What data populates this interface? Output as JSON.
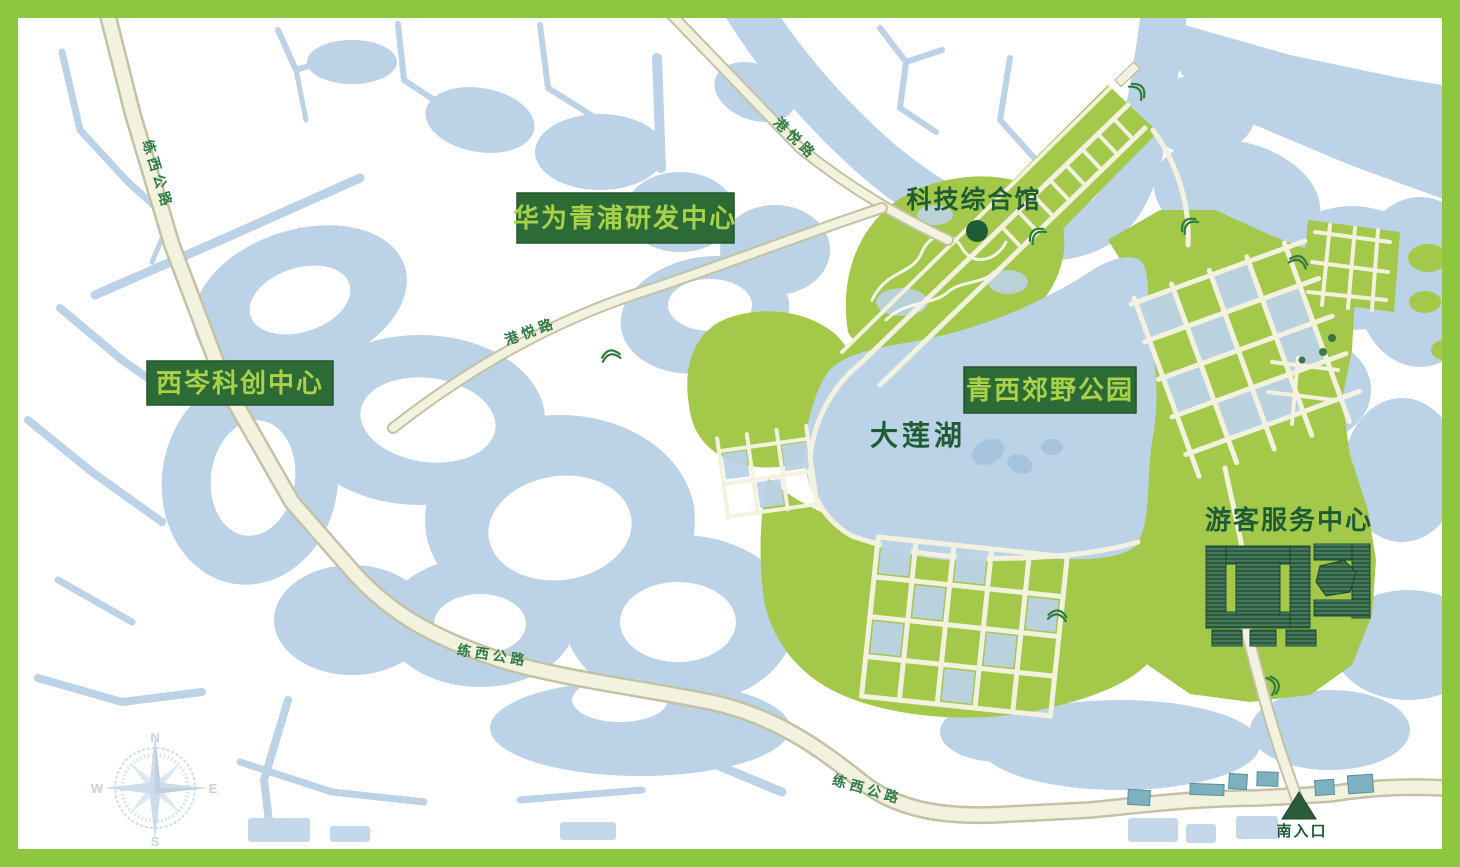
{
  "badges": [
    {
      "id": "huawei-rd-center",
      "label": "华为青浦研发中心"
    },
    {
      "id": "xicen-innovation-center",
      "label": "西岑科创中心"
    },
    {
      "id": "qingxi-country-park",
      "label": "青西郊野公园"
    }
  ],
  "poi": {
    "tech_hall": {
      "label": "科技综合馆",
      "marker": "circle-marker"
    },
    "dalian_lake": {
      "label": "大莲湖"
    },
    "visitor_center": {
      "label": "游客服务中心"
    },
    "south_entrance": {
      "label": "南入口",
      "marker": "triangle-marker"
    }
  },
  "road_labels": [
    {
      "road": "gangyue-road",
      "text": "港悦路"
    },
    {
      "road": "gangyue-road",
      "text": "港悦路"
    },
    {
      "road": "lianxi-highway",
      "text": "练西公路"
    },
    {
      "road": "lianxi-highway",
      "text": "练西公路"
    },
    {
      "road": "lianxi-highway",
      "text": "练西公路"
    }
  ],
  "compass": {
    "north": "N",
    "south": "S",
    "east": "E",
    "west": "W"
  },
  "icons": {
    "tech_hall_marker": "circle-marker-icon",
    "south_entrance_marker": "triangle-marker-icon",
    "bridge": "bridge-icon",
    "compass": "compass-rose-icon"
  },
  "colors": {
    "border": "#8dc63f",
    "water": "#bcd2e6",
    "water_deep": "#a5c3dc",
    "park_green": "#a3c84a",
    "road_fill": "#f3f2df",
    "road_casing": "#c2c2a6",
    "badge_bg": "#2c6a36",
    "badge_text": "#a9d149",
    "label_dark_green": "#1d5c34",
    "building_dark_green": "#2a5c40",
    "building_teal": "#7fb0bf"
  }
}
